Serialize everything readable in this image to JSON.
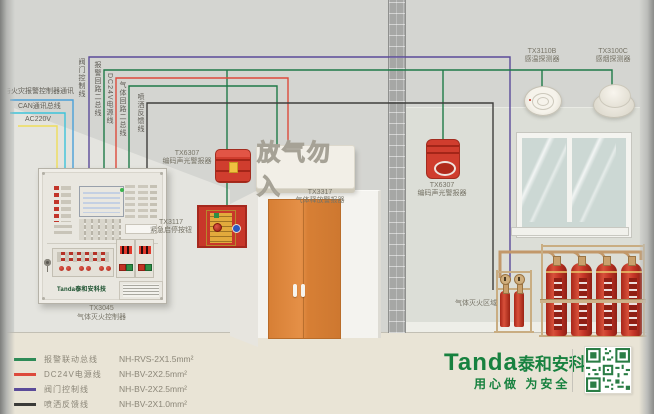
{
  "colors": {
    "wire_alarm_bus": "#1f7a48",
    "wire_dc24v": "#dd4a3c",
    "wire_valve_control": "#5b4b99",
    "wire_spray_feedback": "#3f3e3c",
    "wire_fire_alarm_comm": "#4aa0d8",
    "wire_can_bus": "#3cc3da",
    "wire_ac220v": "#eedd5a",
    "brand_green": "#17813f",
    "door_orange": "#e0873c",
    "device_red": "#d03d2e"
  },
  "wiring": {
    "horizontal_labels": {
      "fire_alarm_comm": "与火灾报警控制器通讯",
      "can_bus": "CAN通讯总线",
      "ac_power": "AC220V"
    },
    "vertical_labels": {
      "valve_control": "阀门控制线",
      "alarm_loop": "报警回路二总线",
      "dc24v": "DC24V电源线",
      "gas_loop": "气体回路二总线",
      "spray_feedback": "喷洒反馈线"
    }
  },
  "controller": {
    "model": "TX3045",
    "name": "气体灭火控制器",
    "panel_logo": "Tanda泰和安科技"
  },
  "devices": {
    "alarm_left": {
      "model": "TX6307",
      "name": "编码声光警报器"
    },
    "emergency_button": {
      "model": "TX3117",
      "name": "紧急启停按钮"
    },
    "gas_release_alarm": {
      "model": "TX3317",
      "name": "气体释放警报器",
      "sign_text": "放气勿入"
    },
    "alarm_right": {
      "model": "TX6307",
      "name": "编码声光警报器"
    },
    "heat_detector": {
      "model": "TX3110B",
      "name": "感温探测器"
    },
    "smoke_detector": {
      "model": "TX3100C",
      "name": "感烟探测器"
    }
  },
  "zone_label": "气体灭火区域",
  "legend": {
    "items": [
      {
        "label": "报警联动总线",
        "spec": "NH-RVS-2X1.5mm²",
        "color": "#2e8b57"
      },
      {
        "label": "DC24V电源线",
        "spec": "NH-BV-2X2.5mm²",
        "color": "#dd4a3c"
      },
      {
        "label": "阀门控制线",
        "spec": "NH-BV-2X2.5mm²",
        "color": "#5b4b99"
      },
      {
        "label": "喷洒反馈线",
        "spec": "NH-BV-2X1.0mm²",
        "color": "#3a3a38"
      }
    ]
  },
  "footer": {
    "brand_en": "Tanda",
    "brand_cn": "泰和安科技",
    "slogan": "用心做  为安全"
  }
}
